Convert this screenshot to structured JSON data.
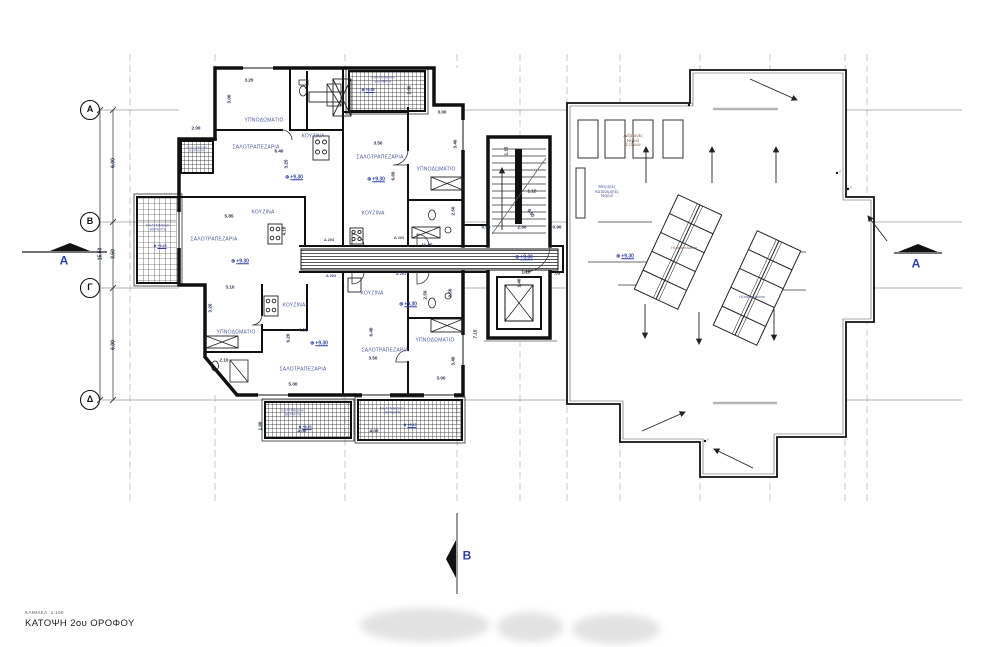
{
  "title_block": {
    "scale_label": "ΚΛΙΜΑΚΑ",
    "scale_value": "1:100",
    "drawing_title": "ΚΑΤΟΨΗ 2ου ΟΡΟΦΟΥ"
  },
  "level_symbol": "⊕",
  "colors": {
    "wall": "#101010",
    "label_blue": "#4b59a1",
    "dimension": "#232c4e",
    "level_blue": "#2b3fa8",
    "grid_line": "#c4c4c4"
  },
  "annotations": [
    {
      "n": "grid-row-label-a",
      "t": "Α",
      "x": 90,
      "y": 110,
      "s": 9,
      "c": "gletter"
    },
    {
      "n": "grid-row-label-b",
      "t": "Β",
      "x": 90,
      "y": 222,
      "s": 9,
      "c": "gletter"
    },
    {
      "n": "grid-row-label-g",
      "t": "Γ",
      "x": 90,
      "y": 288,
      "s": 9,
      "c": "gletter"
    },
    {
      "n": "grid-row-label-d",
      "t": "Δ",
      "x": 90,
      "y": 400,
      "s": 9,
      "c": "gletter"
    },
    {
      "n": "section-label-a-left",
      "t": "A",
      "x": 64,
      "y": 261,
      "s": 12,
      "c": "section"
    },
    {
      "n": "section-label-a-right",
      "t": "A",
      "x": 916,
      "y": 264,
      "s": 12,
      "c": "section"
    },
    {
      "n": "section-label-b-bottom",
      "t": "B",
      "x": 467,
      "y": 556,
      "s": 12,
      "c": "section"
    },
    {
      "n": "grid-dim",
      "t": "6.00",
      "x": 114,
      "y": 163,
      "r": -90,
      "s": 5
    },
    {
      "n": "grid-dim",
      "t": "3.50",
      "x": 114,
      "y": 254,
      "r": -90,
      "s": 5
    },
    {
      "n": "grid-dim",
      "t": "6.00",
      "x": 114,
      "y": 345,
      "r": -90,
      "s": 5
    },
    {
      "n": "grid-dim-total",
      "t": "15.50",
      "x": 101,
      "y": 254,
      "r": -90,
      "s": 5
    },
    {
      "n": "room-label-bedroom",
      "t": "ΥΠΝΟΔΩΜΑΤΙΟ",
      "x": 264,
      "y": 121,
      "s": 5,
      "c": "room"
    },
    {
      "n": "room-label-kitchen",
      "t": "ΚΟΥΖΙΝΑ",
      "x": 313,
      "y": 137,
      "s": 5,
      "c": "room"
    },
    {
      "n": "room-label-living",
      "t": "ΣΑΛΟΤΡΑΠΕΖΑΡΙΑ",
      "x": 256,
      "y": 148,
      "s": 5,
      "c": "room"
    },
    {
      "n": "room-label-living",
      "t": "ΣΑΛΟΤΡΑΠΕΖΑΡΙΑ",
      "x": 214,
      "y": 240,
      "s": 5,
      "c": "room"
    },
    {
      "n": "room-label-kitchen",
      "t": "ΚΟΥΖΙΝΑ",
      "x": 263,
      "y": 213,
      "s": 5,
      "c": "room"
    },
    {
      "n": "room-label-bedroom",
      "t": "ΥΠΝΟΔΩΜΑΤΙΟ",
      "x": 236,
      "y": 333,
      "s": 5,
      "c": "room"
    },
    {
      "n": "room-label-kitchen",
      "t": "ΚΟΥΖΙΝΑ",
      "x": 294,
      "y": 306,
      "s": 5,
      "c": "room"
    },
    {
      "n": "room-label-living",
      "t": "ΣΑΛΟΤΡΑΠΕΖΑΡΙΑ",
      "x": 303,
      "y": 370,
      "s": 5,
      "c": "room"
    },
    {
      "n": "room-label-living",
      "t": "ΣΑΛΟΤΡΑΠΕΖΑΡΙΑ",
      "x": 380,
      "y": 158,
      "s": 5,
      "c": "room"
    },
    {
      "n": "room-label-bedroom",
      "t": "ΥΠΝΟΔΩΜΑΤΙΟ",
      "x": 436,
      "y": 170,
      "s": 5,
      "c": "room"
    },
    {
      "n": "room-label-kitchen",
      "t": "ΚΟΥΖΙΝΑ",
      "x": 373,
      "y": 214,
      "s": 5,
      "c": "room"
    },
    {
      "n": "room-label-kitchen",
      "t": "ΚΟΥΖΙΝΑ",
      "x": 372,
      "y": 294,
      "s": 5,
      "c": "room"
    },
    {
      "n": "room-label-living",
      "t": "ΣΑΛΟΤΡΑΠΕΖΑΡΙΑ",
      "x": 385,
      "y": 351,
      "s": 5,
      "c": "room"
    },
    {
      "n": "room-label-bedroom",
      "t": "ΥΠΝΟΔΩΜΑΤΙΟ",
      "x": 435,
      "y": 341,
      "s": 5,
      "c": "room"
    },
    {
      "n": "veranda-label",
      "t": "ΚΑΛΥΜΜΕΝΗ\nΒΕΡΑΝΤΑ",
      "x": 158,
      "y": 228,
      "s": 3.4,
      "c": "room"
    },
    {
      "n": "veranda-label",
      "t": "ΚΑΛΥΜΜΕΝΗ\nΒΕΡΑΝΤΑ",
      "x": 197,
      "y": 150,
      "s": 3,
      "c": "room"
    },
    {
      "n": "veranda-label",
      "t": "ΚΑΛΥΜΜΕΝΗ\nΒΕΡΑΝΤΑ",
      "x": 383,
      "y": 80,
      "s": 3.4,
      "c": "room"
    },
    {
      "n": "veranda-label",
      "t": "ΚΑΛΥΜΜΕΝΗ\nΒΕΡΑΝΤΑ",
      "x": 293,
      "y": 413,
      "s": 3.4,
      "c": "room"
    },
    {
      "n": "veranda-label",
      "t": "ΚΑΛΥΜΜΕΝΗ\nΒΕΡΑΝΤΑ",
      "x": 392,
      "y": 411,
      "s": 3.4,
      "c": "room"
    },
    {
      "n": "level-marker",
      "t": "+9.30",
      "x": 294,
      "y": 178,
      "s": 5,
      "c": "level",
      "sym": true
    },
    {
      "n": "level-marker",
      "t": "+9.30",
      "x": 240,
      "y": 262,
      "s": 5,
      "c": "level",
      "sym": true
    },
    {
      "n": "level-marker",
      "t": "+9.30",
      "x": 319,
      "y": 344,
      "s": 5,
      "c": "level",
      "sym": true
    },
    {
      "n": "level-marker",
      "t": "+9.30",
      "x": 376,
      "y": 180,
      "s": 5,
      "c": "level",
      "sym": true
    },
    {
      "n": "level-marker",
      "t": "+9.30",
      "x": 408,
      "y": 305,
      "s": 5,
      "c": "level",
      "sym": true
    },
    {
      "n": "level-marker",
      "t": "+9.30",
      "x": 524,
      "y": 258,
      "s": 5,
      "c": "level",
      "sym": true
    },
    {
      "n": "level-marker",
      "t": "+9.30",
      "x": 625,
      "y": 257,
      "s": 5,
      "c": "level",
      "sym": true
    },
    {
      "n": "level-marker",
      "t": "+9.25",
      "x": 160,
      "y": 247,
      "s": 3.6,
      "c": "level",
      "sym": true
    },
    {
      "n": "level-marker",
      "t": "+9.25",
      "x": 368,
      "y": 91,
      "s": 3.6,
      "c": "level",
      "sym": true
    },
    {
      "n": "level-marker",
      "t": "+9.25",
      "x": 305,
      "y": 428,
      "s": 3.6,
      "c": "level",
      "sym": true
    },
    {
      "n": "level-marker",
      "t": "+9.25",
      "x": 410,
      "y": 426,
      "s": 3.6,
      "c": "level",
      "sym": true
    },
    {
      "n": "dimension-label",
      "t": "3.20",
      "x": 249,
      "y": 80,
      "s": 4.6
    },
    {
      "n": "dimension-label",
      "t": "3.00",
      "x": 229,
      "y": 99,
      "r": -90,
      "s": 4.6
    },
    {
      "n": "dimension-label",
      "t": "6.40",
      "x": 279,
      "y": 151,
      "s": 4.6
    },
    {
      "n": "dimension-label",
      "t": "3.25",
      "x": 286,
      "y": 164,
      "r": -90,
      "s": 4.6
    },
    {
      "n": "dimension-label",
      "t": "2.00",
      "x": 196,
      "y": 128,
      "s": 4.6
    },
    {
      "n": "dimension-label",
      "t": "5.85",
      "x": 229,
      "y": 216,
      "s": 4.6
    },
    {
      "n": "dimension-label",
      "t": "4.10",
      "x": 284,
      "y": 231,
      "r": -90,
      "s": 4.6
    },
    {
      "n": "dimension-label",
      "t": "3.10",
      "x": 230,
      "y": 287,
      "s": 4.6
    },
    {
      "n": "dimension-label",
      "t": "3.20",
      "x": 210,
      "y": 308,
      "r": -90,
      "s": 4.6
    },
    {
      "n": "dimension-label",
      "t": "4.00",
      "x": 303,
      "y": 330,
      "s": 4.6
    },
    {
      "n": "dimension-label",
      "t": "6.20",
      "x": 288,
      "y": 338,
      "r": -90,
      "s": 4.6
    },
    {
      "n": "dimension-label",
      "t": "5.00",
      "x": 293,
      "y": 384,
      "s": 4.6
    },
    {
      "n": "dimension-label",
      "t": "2.10",
      "x": 224,
      "y": 360,
      "s": 4.6
    },
    {
      "n": "dimension-label",
      "t": "3.50",
      "x": 378,
      "y": 143,
      "s": 4.6
    },
    {
      "n": "dimension-label",
      "t": "6.60",
      "x": 393,
      "y": 176,
      "r": -90,
      "s": 4.6
    },
    {
      "n": "dimension-label",
      "t": "3.00",
      "x": 442,
      "y": 112,
      "s": 4.6
    },
    {
      "n": "dimension-label",
      "t": "3.40",
      "x": 455,
      "y": 144,
      "r": -90,
      "s": 4.6
    },
    {
      "n": "dimension-label",
      "t": "2.00",
      "x": 409,
      "y": 90,
      "r": -90,
      "s": 4.6
    },
    {
      "n": "dimension-label",
      "t": "2.50",
      "x": 453,
      "y": 211,
      "r": -90,
      "s": 4.6
    },
    {
      "n": "dimension-label",
      "t": "3.50",
      "x": 373,
      "y": 358,
      "s": 4.6
    },
    {
      "n": "dimension-label",
      "t": "6.40",
      "x": 371,
      "y": 332,
      "r": -90,
      "s": 4.6
    },
    {
      "n": "dimension-label",
      "t": "3.00",
      "x": 441,
      "y": 378,
      "s": 4.6
    },
    {
      "n": "dimension-label",
      "t": "3.40",
      "x": 453,
      "y": 361,
      "r": -90,
      "s": 4.6
    },
    {
      "n": "dimension-label",
      "t": "2.50",
      "x": 425,
      "y": 295,
      "r": -90,
      "s": 4.6
    },
    {
      "n": "dimension-label",
      "t": "2.50",
      "x": 450,
      "y": 293,
      "r": -90,
      "s": 4.6
    },
    {
      "n": "dimension-label",
      "t": "7.15",
      "x": 475,
      "y": 334,
      "r": -90,
      "s": 4.6
    },
    {
      "n": "dimension-label",
      "t": "1.15",
      "x": 506,
      "y": 151,
      "r": -90,
      "s": 4.6
    },
    {
      "n": "dimension-label",
      "t": "1.15",
      "x": 532,
      "y": 191,
      "s": 4.6
    },
    {
      "n": "dimension-label",
      "t": "0.95",
      "x": 531,
      "y": 213,
      "r": 55,
      "s": 4.6
    },
    {
      "n": "dimension-label",
      "t": "2.50",
      "x": 522,
      "y": 227,
      "s": 4.6
    },
    {
      "n": "dimension-label",
      "t": "0.90",
      "x": 486,
      "y": 227,
      "s": 4.6
    },
    {
      "n": "dimension-label",
      "t": "0.90",
      "x": 557,
      "y": 227,
      "s": 4.6
    },
    {
      "n": "dimension-label",
      "t": "1.40",
      "x": 519,
      "y": 283,
      "r": -90,
      "s": 4.6
    },
    {
      "n": "dimension-label",
      "t": "1.10",
      "x": 526,
      "y": 272,
      "s": 4.6
    },
    {
      "n": "dimension-label",
      "t": ".35",
      "x": 557,
      "y": 273,
      "s": 4.6
    },
    {
      "n": "dimension-label",
      "t": "11.95",
      "x": 427,
      "y": 245,
      "s": 4.6
    },
    {
      "n": "dimension-label",
      "t": "4.00",
      "x": 302,
      "y": 431,
      "s": 4.6
    },
    {
      "n": "dimension-label",
      "t": "1.90",
      "x": 260,
      "y": 426,
      "r": -90,
      "s": 4.6
    },
    {
      "n": "dimension-label",
      "t": "4.00",
      "x": 374,
      "y": 431,
      "s": 4.6
    },
    {
      "n": "apartment-door-label",
      "t": "Δ 204",
      "x": 329,
      "y": 240,
      "s": 3.8,
      "c": "door"
    },
    {
      "n": "apartment-door-label",
      "t": "Δ 203",
      "x": 399,
      "y": 238,
      "s": 3.8,
      "c": "door"
    },
    {
      "n": "apartment-door-label",
      "t": "Δ 202",
      "x": 331,
      "y": 276,
      "s": 3.8,
      "c": "door"
    },
    {
      "n": "apartment-door-label",
      "t": "Δ 201",
      "x": 401,
      "y": 274,
      "s": 3.8,
      "c": "door"
    },
    {
      "n": "roof-label-water-tanks",
      "t": "Δεξαμενές\nΝερού\n2 τόνων",
      "x": 633,
      "y": 141,
      "s": 4.2,
      "c": "roofa"
    },
    {
      "n": "roof-label-water-meters",
      "t": "Μετρητές\nΚατανεμητές\nΝερού",
      "x": 607,
      "y": 192,
      "s": 4.2,
      "c": "roofb"
    },
    {
      "n": "roof-label-solar-panels",
      "t": "Ηλιακά πλαίσια",
      "x": 684,
      "y": 248,
      "s": 3.8,
      "c": "roofa"
    },
    {
      "n": "roof-label-solar-panels",
      "t": "Ηλιακά πλαίσια",
      "x": 752,
      "y": 297,
      "s": 3.8,
      "c": "roofb"
    },
    {
      "n": "downspout-mark",
      "t": "Y",
      "x": 692,
      "y": 105,
      "s": 3.4,
      "c": "ymark"
    },
    {
      "n": "downspout-mark",
      "t": "Y",
      "x": 840,
      "y": 173,
      "s": 3.4,
      "c": "ymark"
    },
    {
      "n": "downspout-mark",
      "t": "Y",
      "x": 851,
      "y": 189,
      "s": 3.4,
      "c": "ymark"
    },
    {
      "n": "downspout-mark",
      "t": "Y",
      "x": 708,
      "y": 441,
      "s": 3.4,
      "c": "ymark"
    }
  ]
}
